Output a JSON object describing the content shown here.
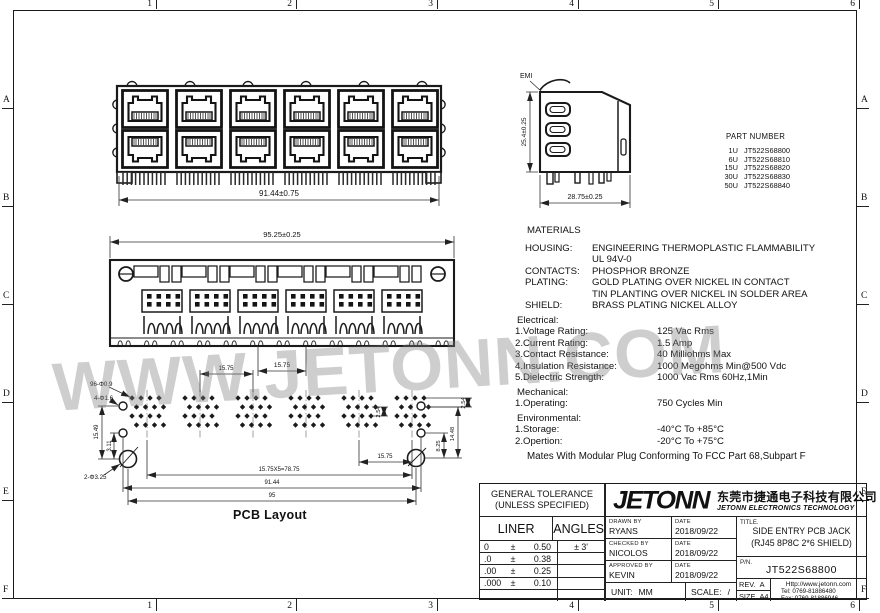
{
  "frame": {
    "cols": [
      "1",
      "2",
      "3",
      "4",
      "5",
      "6"
    ],
    "rows": [
      "A",
      "B",
      "C",
      "D",
      "E",
      "F"
    ]
  },
  "watermark": "WWW.JETONN.COM",
  "front_view": {
    "dim_width": "91.44±0.75"
  },
  "side_view": {
    "emi_label": "EMI",
    "dim_height": "25.4±0.25",
    "dim_depth": "28.75±0.25"
  },
  "rear_view": {
    "dim_width": "95.25±0.25",
    "dim_pitch": "15.75"
  },
  "part_numbers": {
    "title": "PART NUMBER",
    "items": [
      {
        "u": "1U",
        "pn": "JT522S68800"
      },
      {
        "u": "6U",
        "pn": "JT522S68810"
      },
      {
        "u": "15U",
        "pn": "JT522S68820"
      },
      {
        "u": "30U",
        "pn": "JT522S68830"
      },
      {
        "u": "50U",
        "pn": "JT522S68840"
      }
    ]
  },
  "specs": {
    "rows": [
      {
        "c": "sec0",
        "l": "MATERIALS",
        "v": ""
      },
      {
        "c": "mat",
        "l": "HOUSING:",
        "v": "ENGINEERING THERMOPLASTIC FLAMMABILITY"
      },
      {
        "c": "mat",
        "l": "",
        "v": "UL 94V-0"
      },
      {
        "c": "mat",
        "l": "CONTACTS:",
        "v": "PHOSPHOR BRONZE"
      },
      {
        "c": "mat",
        "l": "PLATING:",
        "v": "GOLD PLATING OVER NICKEL IN CONTACT"
      },
      {
        "c": "mat",
        "l": "",
        "v": "TIN PLANTING OVER NICKEL IN SOLDER AREA"
      },
      {
        "c": "mat",
        "l": "SHIELD:",
        "v": "BRASS PLATING NICKEL ALLOY"
      },
      {
        "c": "sec",
        "l": "Electrical:",
        "v": ""
      },
      {
        "c": "item",
        "l": "1.Voltage Rating:",
        "v": "125 Vac Rms"
      },
      {
        "c": "item",
        "l": "2.Current Rating:",
        "v": "1.5 Amp"
      },
      {
        "c": "item",
        "l": "3.Contact Resistance:",
        "v": "40 Milliohms Max"
      },
      {
        "c": "item",
        "l": "4.Insulation Resistance:",
        "v": "1000 Megohms Min@500 Vdc"
      },
      {
        "c": "item",
        "l": "5.Dielectric Strength:",
        "v": "1000 Vac Rms 60Hz,1Min"
      },
      {
        "c": "sec",
        "l": "Mechanical:",
        "v": ""
      },
      {
        "c": "item",
        "l": "1.Operating:",
        "v": "750 Cycles Min"
      },
      {
        "c": "sec",
        "l": "Environmental:",
        "v": ""
      },
      {
        "c": "item",
        "l": "1.Storage:",
        "v": "-40°C To +85°C"
      },
      {
        "c": "item",
        "l": "2.Opertion:",
        "v": "-20°C To +75°C"
      }
    ],
    "mates_note": "Mates With Modular Plug Conforming To FCC Part 68,Subpart F"
  },
  "pcb": {
    "caption": "PCB Layout",
    "dims": {
      "holes_small": "96-Φ0.9",
      "holes_mid": "4-Φ1.6",
      "holes_big": "2-Φ3.25",
      "v_15_49": "15.49",
      "v_3_11": "3.11",
      "v_2_54_mid": "2.54",
      "v_2_54_right": "2.54",
      "v_8_25": "8.25",
      "v_14_48": "14.48",
      "h_15_75": "15.75",
      "pitch_total": "15.75X5=78.75",
      "h_91_44": "91.44",
      "h_95": "95",
      "pitch_top": "15.75"
    }
  },
  "title_block": {
    "tolerance": {
      "title_1": "GENERAL TOLERANCE",
      "title_2": "(UNLESS SPECIFIED)",
      "liner_label": "LINER",
      "angles_label": "ANGLES",
      "rows": [
        {
          "p": "0",
          "pm": "±",
          "t": "0.50",
          "a": "± 3'"
        },
        {
          "p": ".0",
          "pm": "±",
          "t": "0.38",
          "a": ""
        },
        {
          "p": ".00",
          "pm": "±",
          "t": "0.25",
          "a": ""
        },
        {
          "p": ".000",
          "pm": "±",
          "t": "0.10",
          "a": ""
        },
        {
          "p": "",
          "pm": "",
          "t": "",
          "a": ""
        }
      ]
    },
    "logo": {
      "brand": "JETONN",
      "brand_cn": "东莞市捷通电子科技有限公司",
      "brand_en": "JETONN ELECTRONICS TECHNOLOGY"
    },
    "signoff": [
      {
        "role": "DRAWN BY",
        "name": "RYANS",
        "date_label": "DATE",
        "date": "2018/09/22"
      },
      {
        "role": "CHECKED BY",
        "name": "NICOLOS",
        "date_label": "DATE",
        "date": "2018/09/22"
      },
      {
        "role": "APPROVED BY",
        "name": "KEVIN",
        "date_label": "DATE",
        "date": "2018/09/22"
      }
    ],
    "unit_label": "UNIT:",
    "unit_value": "MM",
    "scale_label": "SCALE:",
    "scale_value": "/",
    "title_label": "TITLE.",
    "title_line1": "SIDE ENTRY PCB JACK",
    "title_line2": "(RJ45  8P8C 2*6 SHIELD)",
    "pn_label": "P/N.",
    "pn_value": "JT522S68800",
    "rev_label": "REV.",
    "rev_value": "A",
    "size_label": "SIZE",
    "size_value": "A4",
    "contact": {
      "url": "Http://www.jetonn.com",
      "tel": "Tel:  0769-81886480",
      "fax": "Fax:  0769-81886946"
    }
  }
}
